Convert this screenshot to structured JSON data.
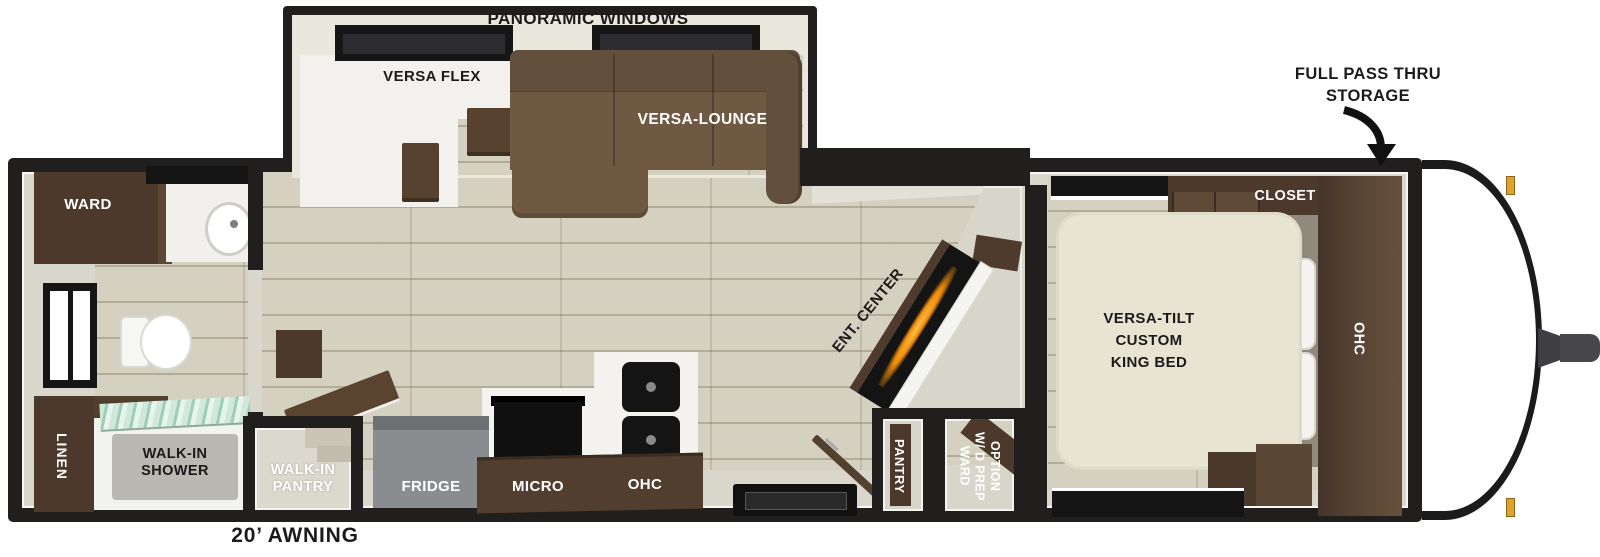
{
  "title": "Travel trailer floor plan",
  "colors": {
    "wall": "#211f1d",
    "floor_plank": "#d5d1c0",
    "cabinet_dark": "#4c392b",
    "cabinet_mid": "#5d4937",
    "sofa_brown": "#6f5942",
    "bed_cream": "#e8e4d2",
    "fridge_gray": "#8a8d8f",
    "glass_green": "#a5cdbb",
    "fireplace_orange": "#f29a1a",
    "marker_amber": "#e0a12f"
  },
  "labels": {
    "panoramic_windows": "PANORAMIC WINDOWS",
    "versa_flex": "VERSA FLEX",
    "versa_lounge": "VERSA-LOUNGE",
    "full_pass_thru_line1": "FULL PASS THRU",
    "full_pass_thru_line2": "STORAGE",
    "closet": "CLOSET",
    "ward_bath": "WARD",
    "ent_center": "ENT. CENTER",
    "bed_line1": "VERSA-TILT",
    "bed_line2": "CUSTOM",
    "bed_line3": "KING BED",
    "ohc_bedroom": "OHC",
    "linen": "LINEN",
    "shower_line1": "WALK-IN",
    "shower_line2": "SHOWER",
    "pantry_room_line1": "WALK-IN",
    "pantry_room_line2": "PANTRY",
    "fridge": "FRIDGE",
    "micro": "MICRO",
    "ohc_kitchen": "OHC",
    "pantry_closet": "PANTRY",
    "ward_wd_line1": "WARD",
    "ward_wd_line2": "W/ D PREP",
    "ward_wd_line3": "OPTION",
    "awning": "20’ AWNING"
  }
}
